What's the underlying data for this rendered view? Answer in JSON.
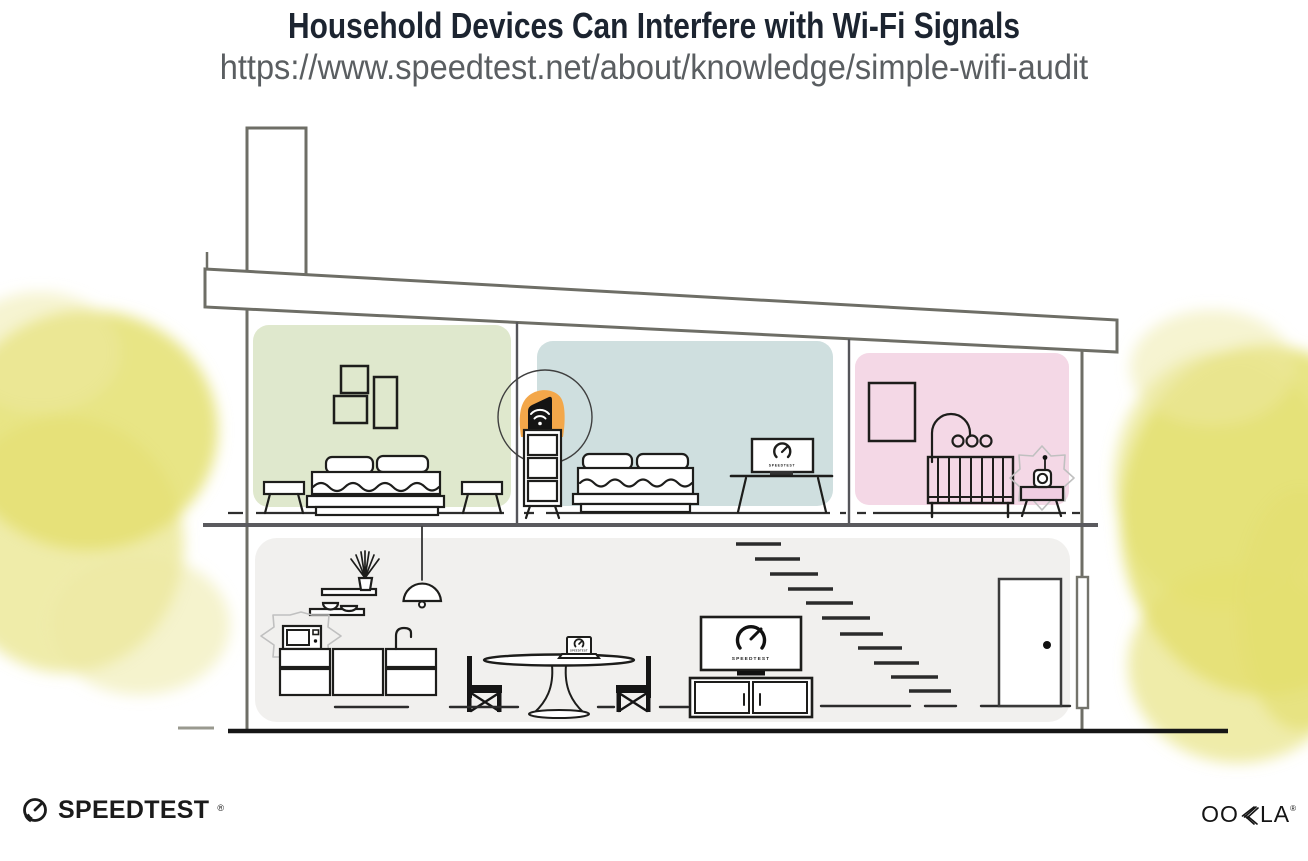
{
  "header": {
    "title": "Household Devices Can Interfere with Wi-Fi Signals",
    "url": "https://www.speedtest.net/about/knowledge/simple-wifi-audit"
  },
  "devices": {
    "living_tv_text": "SPEEDTEST",
    "bedroom_tv_text": "SPEEDTEST",
    "laptop_text": "SPEEDTEST"
  },
  "footer": {
    "speedtest_wordmark": "SPEEDTEST",
    "speedtest_reg": "®",
    "ookla_wordmark": "OOKLA",
    "ookla_parts": {
      "oo": "OO",
      "la": "LA"
    },
    "ookla_reg": "®"
  },
  "colors": {
    "room_green": "#dfe8cd",
    "room_blue": "#cfdfdf",
    "room_pink": "#f4d8e6",
    "floor_gray": "#f1f0ee",
    "router_highlight": "#f3a74a",
    "monitor_table_pink": "#f0cde1",
    "foliage_yellow": "#e4e070",
    "foliage_yellow_light": "#edeaa4",
    "title_navy": "#1c2430",
    "url_gray": "#5a5e61",
    "line_dark": "#1d1d1b",
    "structure_gray": "#6e6e66"
  }
}
